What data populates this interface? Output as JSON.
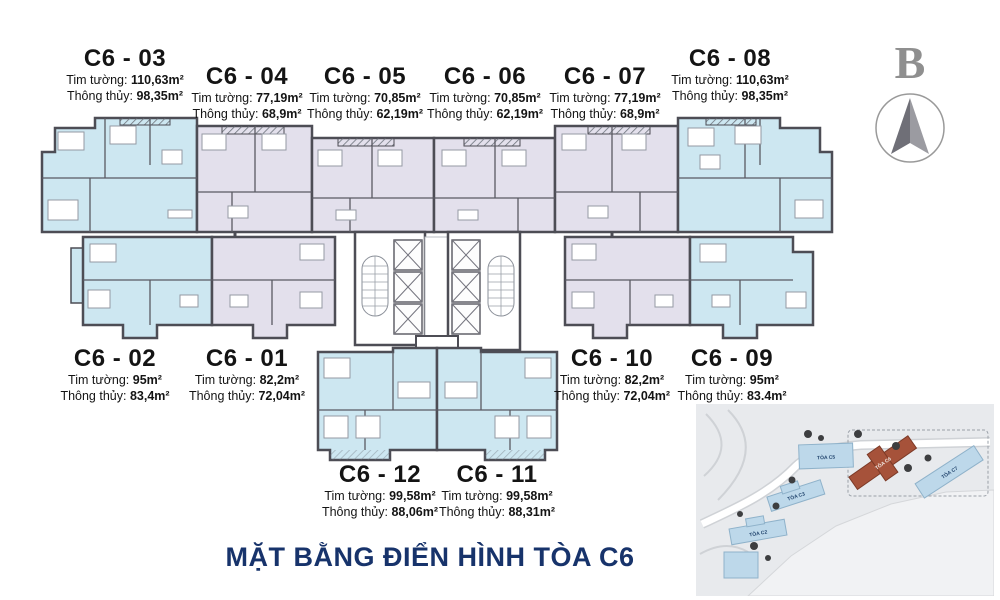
{
  "title": {
    "text": "MẶT BẰNG ĐIỂN HÌNH TÒA C6"
  },
  "labels": {
    "gross_prefix": "Tim tường:",
    "net_prefix": "Thông thủy:"
  },
  "units": [
    {
      "code": "C6 - 03",
      "gross": "110,63m²",
      "net": "98,35m²"
    },
    {
      "code": "C6 - 04",
      "gross": "77,19m²",
      "net": "68,9m²"
    },
    {
      "code": "C6 - 05",
      "gross": "70,85m²",
      "net": "62,19m²"
    },
    {
      "code": "C6 - 06",
      "gross": "70,85m²",
      "net": "62,19m²"
    },
    {
      "code": "C6 - 07",
      "gross": "77,19m²",
      "net": "68,9m²"
    },
    {
      "code": "C6 - 08",
      "gross": "110,63m²",
      "net": "98,35m²"
    },
    {
      "code": "C6 - 02",
      "gross": "95m²",
      "net": "83,4m²"
    },
    {
      "code": "C6 - 01",
      "gross": "82,2m²",
      "net": "72,04m²"
    },
    {
      "code": "C6 - 10",
      "gross": "82,2m²",
      "net": "72,04m²"
    },
    {
      "code": "C6 - 09",
      "gross": "95m²",
      "net": "83.4m²"
    },
    {
      "code": "C6 - 12",
      "gross": "99,58m²",
      "net": "88,06m²"
    },
    {
      "code": "C6 - 11",
      "gross": "99,58m²",
      "net": "88,31m²"
    }
  ],
  "compass": {
    "letter": "B"
  },
  "site_map": {
    "buildings": [
      {
        "label": "TÒA C5"
      },
      {
        "label": "TÒA C6",
        "highlighted": true
      },
      {
        "label": "TÒA C7"
      },
      {
        "label": "TÒA C3"
      },
      {
        "label": "TÒA C2"
      }
    ]
  },
  "colors": {
    "unit_blue": "#cde7f1",
    "unit_lavender": "#e3e0ec",
    "wall": "#4d4d55",
    "title_navy": "#17336b",
    "map_bg": "#e8eaed",
    "map_building_blue": "#bdd8ea",
    "map_highlight_red": "#a6523a"
  }
}
